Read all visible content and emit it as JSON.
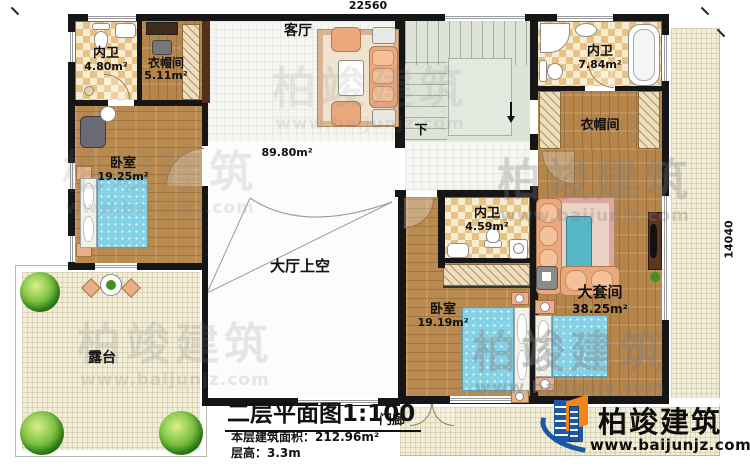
{
  "dimensions": {
    "top_width": "22560",
    "right_height": "14040"
  },
  "rooms": {
    "bath_top_left": {
      "name": "内卫",
      "area": "4.80m²"
    },
    "closet_top_left": {
      "name": "衣帽间",
      "area": "5.11m²"
    },
    "living_room": {
      "name": "客厅",
      "area": "89.80m²"
    },
    "bath_top_right": {
      "name": "内卫",
      "area": "7.84m²"
    },
    "closet_top_right": {
      "name": "衣帽间"
    },
    "bedroom_left": {
      "name": "卧室",
      "area": "19.25m²"
    },
    "hall_void": {
      "name": "大厅上空"
    },
    "bath_middle": {
      "name": "内卫",
      "area": "4.59m²"
    },
    "master_suite": {
      "name": "大套间",
      "area": "38.25m²"
    },
    "bedroom_bottom": {
      "name": "卧室",
      "area": "19.19m²"
    },
    "terrace": {
      "name": "露台"
    },
    "porch": {
      "name": "门廊"
    }
  },
  "stairs": {
    "down_label": "下"
  },
  "title_block": {
    "title": "二层平面图1:100",
    "area_label": "本层建筑面积：",
    "area_value": "212.96m²",
    "height_label": "层高：",
    "height_value": "3.3m"
  },
  "brand": {
    "name": "柏竣建筑",
    "site": "www.baijunjz.com"
  },
  "watermark": {
    "name": "柏竣建筑",
    "site": "www.baijunjz.com"
  },
  "colors": {
    "wall": "#161616",
    "wood": "#b5854c",
    "tile": "#f5f5f1",
    "checker_dark": "#e6c286",
    "checker_light": "#f7ecce",
    "stair": "#dde3d7",
    "outdoor": "#f1edd8",
    "bed": "#85d2e6",
    "sofa": "#eaa87d",
    "logo_blue": "#1c57a5",
    "logo_orange": "#f08519"
  }
}
